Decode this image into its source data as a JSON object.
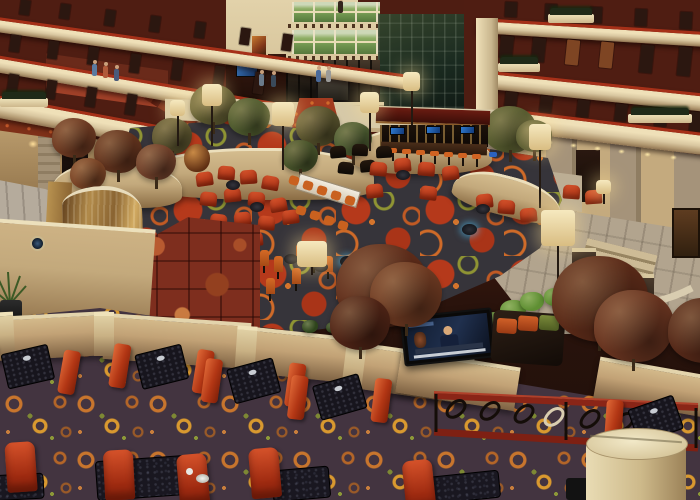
{
  "scene": {
    "label": "Photograph of a multi-storey hotel atrium: balconied guest floors above a lobby with patterned carpet, garden planters, floor lamps, a canopied bar, red lounge seating, a bronze waterfall wall with marble surround, and a foreground dining terrace with red booths, a wall-mounted TV and a wrought-iron railing.",
    "setting": "hotel-atrium-lobby",
    "visible_text": "none"
  },
  "palette": {
    "balcony_wall": "#4f1d12",
    "balcony_front": "#d9c7a0",
    "balcony_trim": "#a63018",
    "lobby_carpet_base": "#36343a",
    "lobby_carpet_red": "#b5391b",
    "lobby_carpet_orange": "#cf6a28",
    "terrace_carpet_base": "#433440",
    "terrace_carpet_orange": "#c8752d",
    "terrace_carpet_gold": "#d9992f",
    "chair_red": "#c23f1e",
    "chair_orange": "#c9611f",
    "table_black": "#17151d",
    "planter_tan": "#c3a97c",
    "stone_pillar": "#a5937a",
    "walkway": "#b2a48e",
    "bronze_waterfall": "#a5793d",
    "marble_red": "#7e2e1e",
    "water": "#9fb0a6",
    "lamp_shade": "#ecdcae",
    "window_green": "#6f944e",
    "railing_red": "#8a2517",
    "iron_black": "#140d08"
  },
  "objects": {
    "doors_left_top": [
      {
        "x": 20,
        "y": 0,
        "h": 15
      },
      {
        "x": 60,
        "y": 4,
        "h": 15
      },
      {
        "x": 105,
        "y": 10,
        "h": 16
      },
      {
        "x": 150,
        "y": 16,
        "h": 16
      },
      {
        "x": 195,
        "y": 22,
        "h": 16
      },
      {
        "x": 240,
        "y": 28,
        "h": 17
      },
      {
        "x": 282,
        "y": 34,
        "h": 17
      }
    ],
    "doors_left_mid": [
      {
        "x": 10,
        "y": 35,
        "h": 17
      },
      {
        "x": 48,
        "y": 41,
        "h": 18
      },
      {
        "x": 88,
        "y": 47,
        "h": 18
      },
      {
        "x": 130,
        "y": 54,
        "h": 19
      },
      {
        "x": 172,
        "y": 60,
        "h": 20
      },
      {
        "x": 214,
        "y": 66,
        "h": 21
      },
      {
        "x": 254,
        "y": 72,
        "h": 22
      }
    ],
    "doors_left_low": [
      {
        "x": 8,
        "y": 74,
        "h": 18
      },
      {
        "x": 46,
        "y": 80,
        "h": 19
      },
      {
        "x": 86,
        "y": 87,
        "h": 20
      },
      {
        "x": 126,
        "y": 94,
        "h": 21
      },
      {
        "x": 166,
        "y": 101,
        "h": 22
      },
      {
        "x": 206,
        "y": 108,
        "h": 23
      },
      {
        "x": 246,
        "y": 115,
        "h": 24
      }
    ],
    "doors_right_top": [
      {
        "x": 505,
        "y": 2,
        "h": 15
      },
      {
        "x": 545,
        "y": 4,
        "h": 16
      },
      {
        "x": 590,
        "y": 7,
        "h": 16
      },
      {
        "x": 635,
        "y": 9,
        "h": 17
      },
      {
        "x": 680,
        "y": 12,
        "h": 17
      }
    ],
    "doors_right_mid": [
      {
        "x": 500,
        "y": 36,
        "h": 22
      },
      {
        "x": 532,
        "y": 38,
        "h": 24
      },
      {
        "x": 566,
        "y": 40,
        "h": 25,
        "c": "#7e4523"
      },
      {
        "x": 600,
        "y": 42,
        "h": 26,
        "c": "#7e4523"
      },
      {
        "x": 640,
        "y": 45,
        "h": 28
      },
      {
        "x": 678,
        "y": 47,
        "h": 29
      }
    ],
    "doors_right_low": [
      {
        "x": 505,
        "y": 92,
        "h": 15
      },
      {
        "x": 540,
        "y": 96,
        "h": 16
      },
      {
        "x": 577,
        "y": 100,
        "h": 17
      },
      {
        "x": 615,
        "y": 104,
        "h": 17
      },
      {
        "x": 655,
        "y": 108,
        "h": 18
      },
      {
        "x": 690,
        "y": 112,
        "h": 19
      }
    ],
    "ledge_planters": [
      {
        "x": 548,
        "y": 14,
        "w": 46
      },
      {
        "x": 498,
        "y": 63,
        "w": 42
      },
      {
        "x": 628,
        "y": 114,
        "w": 64
      },
      {
        "x": 0,
        "y": 98,
        "w": 48
      }
    ],
    "people": [
      {
        "x": 316,
        "y": 70,
        "c": "#4a6a9a"
      },
      {
        "x": 326,
        "y": 70,
        "c": "#9a9a98"
      },
      {
        "x": 92,
        "y": 64,
        "c": "#5a7aa0"
      },
      {
        "x": 103,
        "y": 66,
        "c": "#b05a3a"
      },
      {
        "x": 114,
        "y": 69,
        "c": "#4a5a7a"
      },
      {
        "x": 338,
        "y": 1,
        "c": "#33251d"
      },
      {
        "x": 259,
        "y": 74,
        "c": "#6a7a8a"
      },
      {
        "x": 271,
        "y": 75,
        "c": "#3a4a5a"
      }
    ],
    "downlights": [
      {
        "x": 500,
        "y": 134
      },
      {
        "x": 522,
        "y": 137
      },
      {
        "x": 546,
        "y": 140
      },
      {
        "x": 570,
        "y": 143
      },
      {
        "x": 594,
        "y": 146
      },
      {
        "x": 618,
        "y": 149
      },
      {
        "x": 644,
        "y": 152
      },
      {
        "x": 670,
        "y": 155
      }
    ],
    "sconces": [
      {
        "x": 28,
        "y": 140
      },
      {
        "x": 76,
        "y": 150
      },
      {
        "x": 124,
        "y": 160
      },
      {
        "x": 196,
        "y": 118
      }
    ],
    "lamps": [
      {
        "x": 202,
        "y": 84,
        "w": 20,
        "h": 22,
        "p": 40
      },
      {
        "x": 272,
        "y": 102,
        "w": 22,
        "h": 24,
        "p": 44
      },
      {
        "x": 170,
        "y": 100,
        "w": 15,
        "h": 16,
        "p": 30
      },
      {
        "x": 360,
        "y": 92,
        "w": 19,
        "h": 21,
        "p": 38
      },
      {
        "x": 403,
        "y": 72,
        "w": 17,
        "h": 19,
        "p": 34
      },
      {
        "x": 529,
        "y": 124,
        "w": 22,
        "h": 26,
        "p": 58
      },
      {
        "x": 541,
        "y": 210,
        "w": 34,
        "h": 36,
        "p": 68
      },
      {
        "x": 297,
        "y": 241,
        "w": 30,
        "h": 26,
        "p": 8
      },
      {
        "x": 596,
        "y": 180,
        "w": 15,
        "h": 14,
        "p": 10
      }
    ],
    "trees": [
      {
        "x": 190,
        "y": 84,
        "s": 46,
        "c": "#5d5a30"
      },
      {
        "x": 228,
        "y": 98,
        "s": 42,
        "c": "#4e5a2e"
      },
      {
        "x": 296,
        "y": 106,
        "s": 44,
        "c": "#56512c"
      },
      {
        "x": 334,
        "y": 122,
        "s": 38,
        "c": "#4a5a30"
      },
      {
        "x": 152,
        "y": 118,
        "s": 40,
        "c": "#5a532e"
      },
      {
        "x": 282,
        "y": 140,
        "s": 36,
        "c": "#47532a"
      },
      {
        "x": 484,
        "y": 106,
        "s": 52,
        "c": "#555a2e"
      },
      {
        "x": 516,
        "y": 120,
        "s": 36,
        "c": "#4e532a"
      },
      {
        "x": 52,
        "y": 118,
        "s": 44,
        "c": "#6e3a22"
      },
      {
        "x": 94,
        "y": 130,
        "s": 48,
        "c": "#64341e"
      },
      {
        "x": 136,
        "y": 144,
        "s": 40,
        "c": "#70402a"
      },
      {
        "x": 70,
        "y": 158,
        "s": 36,
        "c": "#7a4426"
      }
    ],
    "foreground_trees": [
      {
        "x": 336,
        "y": 244,
        "s": 92,
        "c": "#5e2c1a"
      },
      {
        "x": 370,
        "y": 262,
        "s": 72,
        "c": "#6e3a22"
      },
      {
        "x": 330,
        "y": 296,
        "s": 60,
        "c": "#4f2416"
      },
      {
        "x": 552,
        "y": 256,
        "s": 96,
        "c": "#5a2a18"
      },
      {
        "x": 594,
        "y": 290,
        "s": 80,
        "c": "#683420"
      },
      {
        "x": 668,
        "y": 298,
        "s": 72,
        "c": "#542818"
      }
    ],
    "lounge_chairs_red": [
      {
        "x": 196,
        "y": 172,
        "r": "-8deg"
      },
      {
        "x": 218,
        "y": 166,
        "r": "5deg"
      },
      {
        "x": 240,
        "y": 170,
        "r": "-4deg"
      },
      {
        "x": 262,
        "y": 176,
        "r": "10deg"
      },
      {
        "x": 200,
        "y": 192,
        "r": "6deg"
      },
      {
        "x": 224,
        "y": 188,
        "r": "-6deg"
      },
      {
        "x": 248,
        "y": 192,
        "r": "4deg"
      },
      {
        "x": 270,
        "y": 198,
        "r": "-10deg"
      },
      {
        "x": 210,
        "y": 214,
        "r": "8deg"
      },
      {
        "x": 234,
        "y": 212,
        "r": "-5deg"
      },
      {
        "x": 258,
        "y": 216,
        "r": "6deg"
      },
      {
        "x": 282,
        "y": 210,
        "r": "-8deg"
      },
      {
        "x": 220,
        "y": 234,
        "r": "4deg"
      },
      {
        "x": 246,
        "y": 232,
        "r": "-4deg"
      },
      {
        "x": 370,
        "y": 162,
        "r": "6deg"
      },
      {
        "x": 394,
        "y": 158,
        "r": "-5deg"
      },
      {
        "x": 418,
        "y": 162,
        "r": "5deg"
      },
      {
        "x": 442,
        "y": 166,
        "r": "-7deg"
      },
      {
        "x": 366,
        "y": 184,
        "r": "-6deg"
      },
      {
        "x": 420,
        "y": 186,
        "r": "7deg"
      },
      {
        "x": 476,
        "y": 194,
        "r": "-6deg"
      },
      {
        "x": 498,
        "y": 200,
        "r": "5deg"
      },
      {
        "x": 520,
        "y": 208,
        "r": "-5deg"
      },
      {
        "x": 563,
        "y": 185,
        "r": "4deg"
      },
      {
        "x": 585,
        "y": 190,
        "r": "-4deg"
      }
    ],
    "lounge_chairs_black": [
      {
        "x": 330,
        "y": 146,
        "r": "-5deg"
      },
      {
        "x": 352,
        "y": 144,
        "r": "3deg"
      },
      {
        "x": 376,
        "y": 146,
        "r": "-3deg"
      },
      {
        "x": 338,
        "y": 162,
        "r": "6deg"
      },
      {
        "x": 360,
        "y": 160,
        "r": "-6deg"
      }
    ],
    "communal_chairs": [
      {
        "x": 289,
        "y": 176
      },
      {
        "x": 303,
        "y": 181
      },
      {
        "x": 317,
        "y": 186
      },
      {
        "x": 331,
        "y": 191
      },
      {
        "x": 345,
        "y": 196
      },
      {
        "x": 296,
        "y": 206
      },
      {
        "x": 310,
        "y": 211
      },
      {
        "x": 324,
        "y": 216
      },
      {
        "x": 338,
        "y": 221
      }
    ],
    "cocktail_chairs": [
      {
        "x": 260,
        "y": 250
      },
      {
        "x": 274,
        "y": 256
      },
      {
        "x": 296,
        "y": 244
      },
      {
        "x": 310,
        "y": 250
      },
      {
        "x": 324,
        "y": 256
      },
      {
        "x": 250,
        "y": 270
      },
      {
        "x": 266,
        "y": 278
      },
      {
        "x": 238,
        "y": 260
      },
      {
        "x": 292,
        "y": 268
      }
    ],
    "side_tables": [
      {
        "x": 226,
        "y": 180
      },
      {
        "x": 250,
        "y": 202
      },
      {
        "x": 396,
        "y": 170
      },
      {
        "x": 476,
        "y": 204
      },
      {
        "x": 284,
        "y": 254
      },
      {
        "x": 314,
        "y": 262
      }
    ],
    "glow_tables": [
      {
        "x": 340,
        "y": 256
      },
      {
        "x": 462,
        "y": 224
      }
    ],
    "bar_tvs": [
      {
        "x": 390,
        "y": 127
      },
      {
        "x": 426,
        "y": 126
      },
      {
        "x": 460,
        "y": 126
      }
    ],
    "bar_stools": [
      {
        "x": 388,
        "y": 148
      },
      {
        "x": 402,
        "y": 149
      },
      {
        "x": 416,
        "y": 150
      },
      {
        "x": 430,
        "y": 151
      },
      {
        "x": 444,
        "y": 152
      },
      {
        "x": 458,
        "y": 153
      },
      {
        "x": 472,
        "y": 154
      }
    ],
    "booths": [
      {
        "x": -24,
        "y": 330,
        "r": "-6deg"
      },
      {
        "x": 110,
        "y": 330,
        "r": "-7deg"
      },
      {
        "x": 202,
        "y": 344,
        "r": "-8deg"
      },
      {
        "x": 288,
        "y": 360,
        "r": "-9deg"
      }
    ],
    "booths_front": [
      {
        "x": 604,
        "y": 382,
        "r": "-12deg"
      }
    ],
    "terrace_walls": [
      {
        "x": -8,
        "y": 314,
        "w": 118,
        "h": 44,
        "r": "-3deg"
      },
      {
        "x": 104,
        "y": 318,
        "w": 146,
        "h": 46,
        "r": "4deg"
      },
      {
        "x": 242,
        "y": 332,
        "w": 116,
        "h": 46,
        "r": "6deg"
      },
      {
        "x": 350,
        "y": 350,
        "w": 122,
        "h": 46,
        "r": "8deg"
      },
      {
        "x": 398,
        "y": 358,
        "w": 120,
        "h": 44,
        "r": "9deg"
      },
      {
        "x": 596,
        "y": 366,
        "w": 112,
        "h": 42,
        "r": "10deg"
      }
    ],
    "wall_posts": [
      {
        "x": -2,
        "y": 312,
        "w": 16,
        "h": 42,
        "r": "-3deg"
      },
      {
        "x": 94,
        "y": 312,
        "w": 20,
        "h": 44,
        "r": "0deg"
      },
      {
        "x": 236,
        "y": 326,
        "w": 20,
        "h": 46,
        "r": "4deg"
      },
      {
        "x": 344,
        "y": 342,
        "w": 20,
        "h": 48,
        "r": "7deg"
      }
    ],
    "shrubs": [
      {
        "x": 480,
        "y": 312,
        "s": 30
      },
      {
        "x": 500,
        "y": 300,
        "s": 26
      },
      {
        "x": 520,
        "y": 292,
        "s": 24
      },
      {
        "x": 544,
        "y": 288,
        "s": 22
      },
      {
        "x": 496,
        "y": 322,
        "s": 24
      },
      {
        "x": 470,
        "y": 326,
        "s": 20
      },
      {
        "x": 560,
        "y": 292,
        "s": 20,
        "c": "#7a3a20"
      },
      {
        "x": 580,
        "y": 290,
        "s": 22,
        "c": "#4e6f2c"
      },
      {
        "x": 302,
        "y": 320,
        "s": 16,
        "c": "#2e441c"
      },
      {
        "x": 326,
        "y": 322,
        "s": 14,
        "c": "#2e441c"
      },
      {
        "x": 352,
        "y": 330,
        "s": 14,
        "c": "#2e441c"
      }
    ],
    "bottom_chairs": [
      {
        "x": 6,
        "y": 442,
        "r": "-4deg"
      },
      {
        "x": 104,
        "y": 450,
        "r": "-3deg"
      },
      {
        "x": 178,
        "y": 454,
        "r": "-5deg"
      },
      {
        "x": 250,
        "y": 448,
        "r": "-5deg"
      },
      {
        "x": 404,
        "y": 460,
        "r": "-6deg"
      }
    ],
    "bottom_tables": [
      {
        "x": 96,
        "y": 458,
        "w": 92,
        "h": 40,
        "r": "-4deg"
      },
      {
        "x": 272,
        "y": 468,
        "w": 58,
        "h": 32,
        "r": "-5deg"
      },
      {
        "x": 414,
        "y": 474,
        "w": 86,
        "h": 28,
        "r": "-6deg"
      },
      {
        "x": -10,
        "y": 474,
        "w": 54,
        "h": 26,
        "r": "-3deg"
      }
    ]
  }
}
